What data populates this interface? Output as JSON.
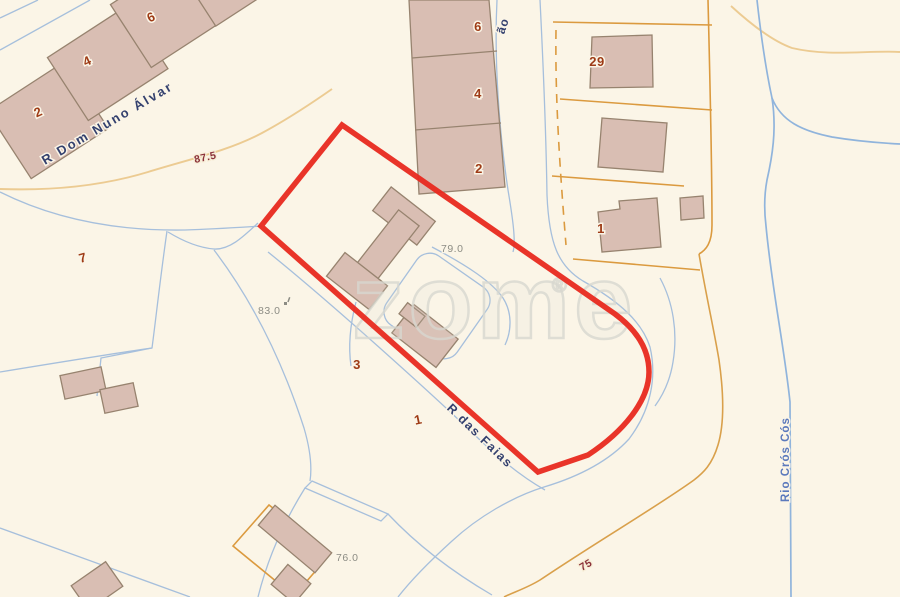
{
  "map": {
    "type": "cadastral-map",
    "watermark": {
      "text": "zome",
      "registered_mark": "®"
    },
    "streets": [
      {
        "id": "r-dom-nuno-alvar",
        "text": "R Dom Nuno Álvar"
      },
      {
        "id": "street-partial-ao",
        "text": "ão"
      },
      {
        "id": "r-das-faias",
        "text": "R das Faias"
      },
      {
        "id": "rio-cros-cos",
        "text": "Rio Crós Cós"
      }
    ],
    "contour_labels": [
      {
        "text": "87.5"
      },
      {
        "text": "75"
      }
    ],
    "spot_elevations": [
      {
        "text": "83.0"
      },
      {
        "text": "79.0"
      },
      {
        "text": "76.0"
      }
    ],
    "house_numbers": [
      {
        "text": "2"
      },
      {
        "text": "4"
      },
      {
        "text": "6"
      },
      {
        "text": "6"
      },
      {
        "text": "4"
      },
      {
        "text": "2"
      },
      {
        "text": "29"
      },
      {
        "text": "1"
      },
      {
        "text": "7"
      },
      {
        "text": "3"
      },
      {
        "text": "1"
      }
    ],
    "colors": {
      "background": "#FBF5E7",
      "building_fill": "#D9BEB3",
      "building_stroke": "#97836F",
      "parcel_line": "#DB9A3F",
      "contour_line": "#ECCB92",
      "road_line": "#A6BFDC",
      "river_line": "#90B4DC",
      "street_label": "#33406E",
      "river_label": "#5B79BC",
      "house_number": "#9E3B16",
      "contour_label": "#8A3038",
      "elevation_label": "#8C8C84",
      "highlight_outline": "#E8291F"
    }
  }
}
